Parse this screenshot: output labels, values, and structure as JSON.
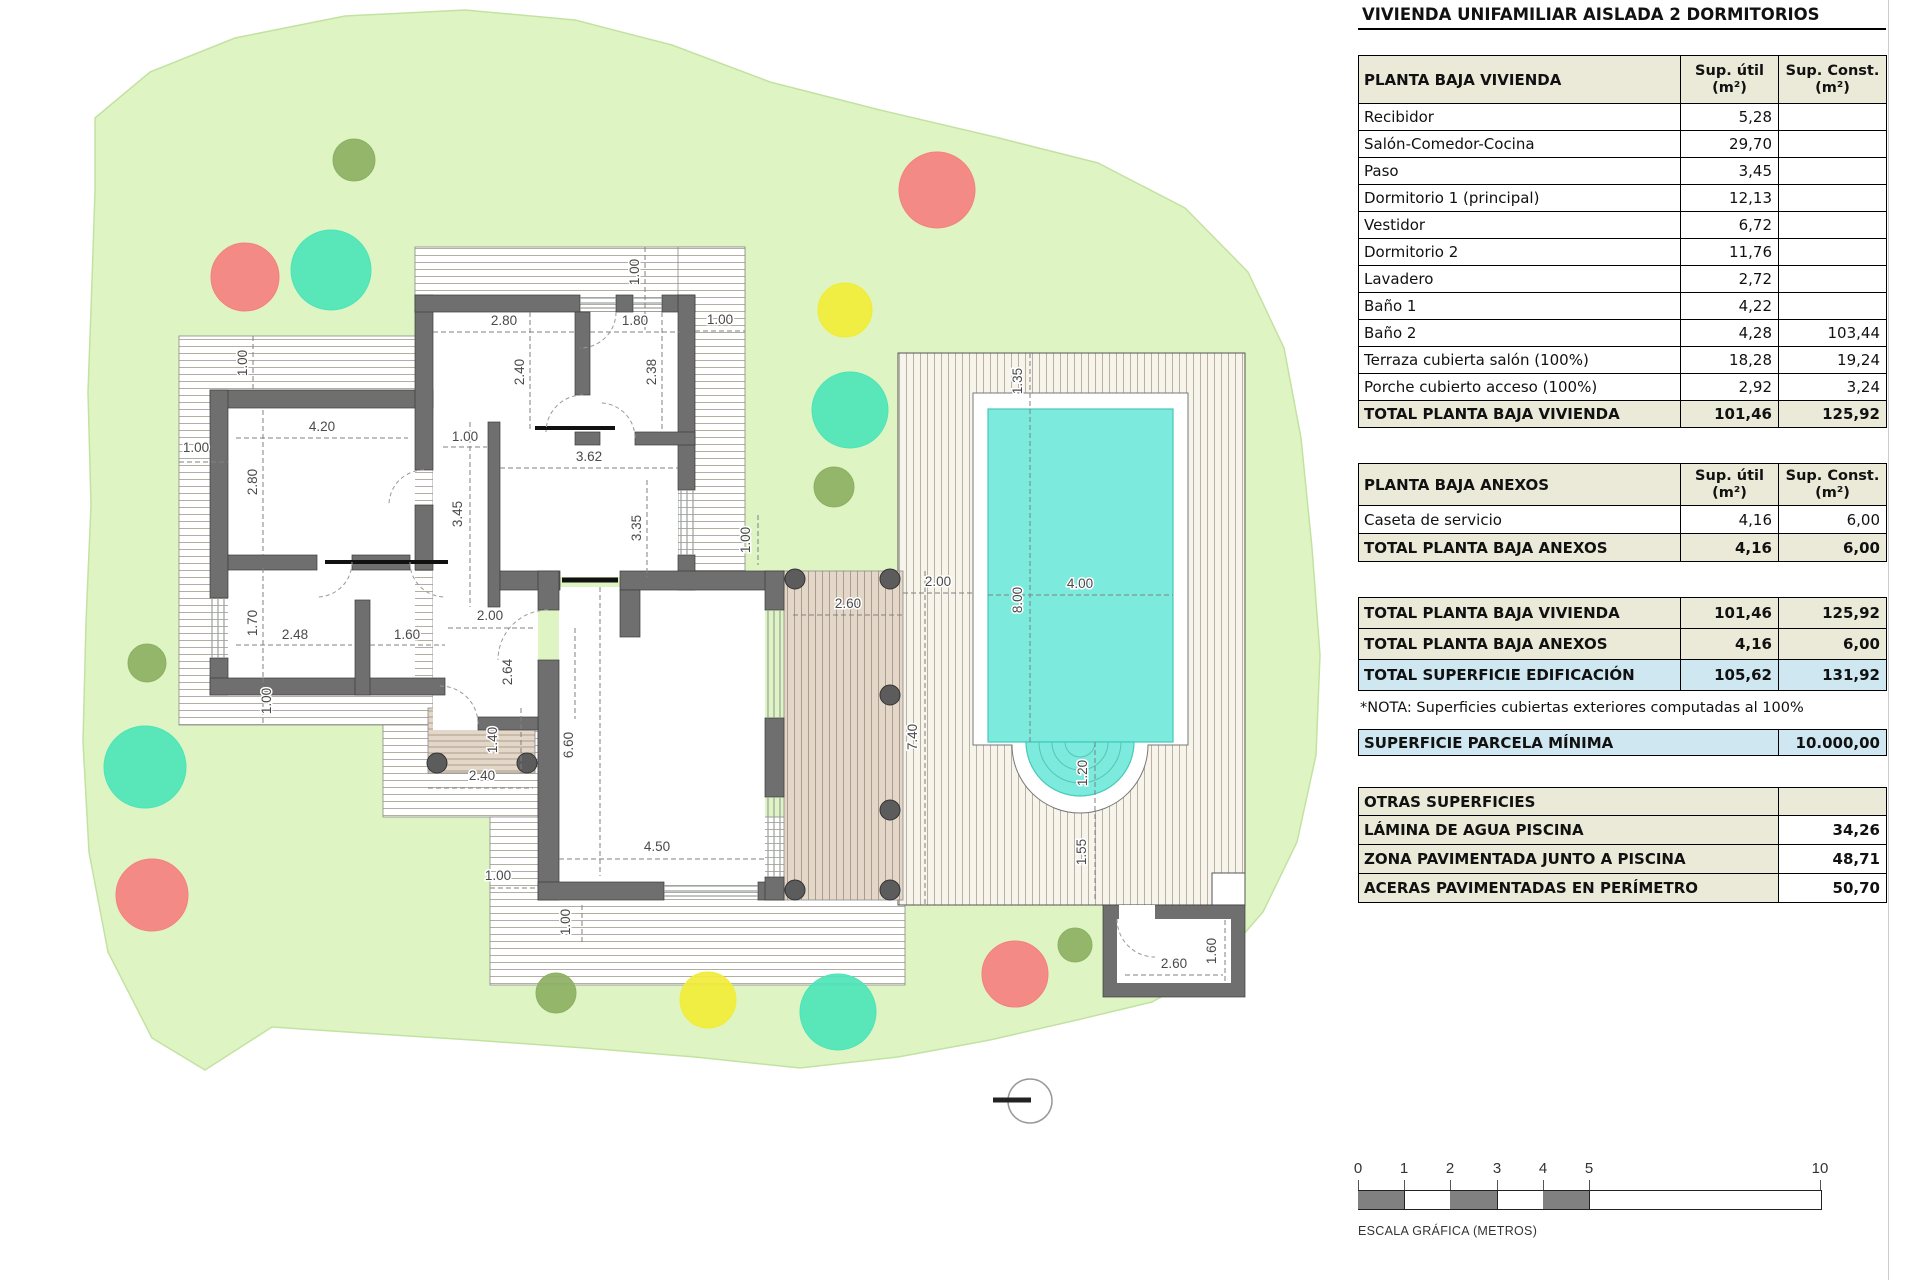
{
  "title": "VIVIENDA UNIFAMILIAR AISLADA 2 DORMITORIOS",
  "columns": {
    "util": "Sup. útil",
    "const": "Sup. Const.",
    "unit": "(m²)"
  },
  "tables": {
    "vivienda": {
      "header": "PLANTA BAJA VIVIENDA",
      "rows": [
        {
          "label": "Recibidor",
          "util": "5,28",
          "const": ""
        },
        {
          "label": "Salón-Comedor-Cocina",
          "util": "29,70",
          "const": ""
        },
        {
          "label": "Paso",
          "util": "3,45",
          "const": ""
        },
        {
          "label": "Dormitorio 1 (principal)",
          "util": "12,13",
          "const": ""
        },
        {
          "label": "Vestidor",
          "util": "6,72",
          "const": ""
        },
        {
          "label": "Dormitorio 2",
          "util": "11,76",
          "const": ""
        },
        {
          "label": "Lavadero",
          "util": "2,72",
          "const": ""
        },
        {
          "label": "Baño 1",
          "util": "4,22",
          "const": ""
        },
        {
          "label": "Baño 2",
          "util": "4,28",
          "const": "103,44"
        },
        {
          "label": "Terraza cubierta salón (100%)",
          "util": "18,28",
          "const": "19,24"
        },
        {
          "label": "Porche cubierto acceso (100%)",
          "util": "2,92",
          "const": "3,24"
        }
      ],
      "total": {
        "label": "TOTAL PLANTA BAJA VIVIENDA",
        "util": "101,46",
        "const": "125,92"
      }
    },
    "anexos": {
      "header": "PLANTA BAJA ANEXOS",
      "rows": [
        {
          "label": "Caseta de servicio",
          "util": "4,16",
          "const": "6,00"
        }
      ],
      "total": {
        "label": "TOTAL PLANTA BAJA ANEXOS",
        "util": "4,16",
        "const": "6,00"
      }
    },
    "resumen": {
      "rows": [
        {
          "label": "TOTAL PLANTA BAJA VIVIENDA",
          "util": "101,46",
          "const": "125,92",
          "style": "beige"
        },
        {
          "label": "TOTAL PLANTA BAJA ANEXOS",
          "util": "4,16",
          "const": "6,00",
          "style": "beige"
        },
        {
          "label": "TOTAL SUPERFICIE EDIFICACIÓN",
          "util": "105,62",
          "const": "131,92",
          "style": "blue"
        }
      ]
    },
    "nota": "*NOTA: Superficies cubiertas exteriores computadas al 100%",
    "parcela": {
      "label": "SUPERFICIE PARCELA MÍNIMA",
      "value": "10.000,00"
    },
    "otras": {
      "header": "OTRAS SUPERFICIES",
      "rows": [
        {
          "label": "LÁMINA DE AGUA PISCINA",
          "value": "34,26"
        },
        {
          "label": "ZONA PAVIMENTADA JUNTO A PISCINA",
          "value": "48,71"
        },
        {
          "label": "ACERAS PAVIMENTADAS EN PERÍMETRO",
          "value": "50,70"
        }
      ]
    }
  },
  "scalebar": {
    "ticks": [
      {
        "t": "0",
        "x": 0
      },
      {
        "t": "1",
        "x": 46
      },
      {
        "t": "2",
        "x": 92
      },
      {
        "t": "3",
        "x": 139
      },
      {
        "t": "4",
        "x": 185
      },
      {
        "t": "5",
        "x": 231
      },
      {
        "t": "10",
        "x": 462
      }
    ],
    "gray_segments": [
      [
        0,
        46
      ],
      [
        92,
        139
      ],
      [
        185,
        231
      ]
    ],
    "caption": "ESCALA GRÁFICA (METROS)"
  },
  "plan": {
    "colors": {
      "parcel": "#def5c3",
      "parcel_edge": "#c3e2a2",
      "wall": "#6f6f6f",
      "wall_edge": "#3c3c3c",
      "pool_water": "#7deade",
      "pool_edge": "#44c9bb",
      "tree_olive": "#8db064",
      "tree_red": "#f48080",
      "tree_teal": "#4de4b8",
      "tree_yellow": "#f1ec38"
    },
    "trees": [
      {
        "x": 354,
        "y": 160,
        "r": 21,
        "c": "#8db064"
      },
      {
        "x": 834,
        "y": 487,
        "r": 20,
        "c": "#8db064"
      },
      {
        "x": 147,
        "y": 663,
        "r": 19,
        "c": "#8db064"
      },
      {
        "x": 556,
        "y": 993,
        "r": 20,
        "c": "#8db064"
      },
      {
        "x": 1075,
        "y": 945,
        "r": 17,
        "c": "#8db064"
      },
      {
        "x": 245,
        "y": 277,
        "r": 34,
        "c": "#f48080"
      },
      {
        "x": 937,
        "y": 190,
        "r": 38,
        "c": "#f48080"
      },
      {
        "x": 152,
        "y": 895,
        "r": 36,
        "c": "#f48080"
      },
      {
        "x": 1015,
        "y": 974,
        "r": 33,
        "c": "#f48080"
      },
      {
        "x": 331,
        "y": 270,
        "r": 40,
        "c": "#4de4b8"
      },
      {
        "x": 850,
        "y": 410,
        "r": 38,
        "c": "#4de4b8"
      },
      {
        "x": 145,
        "y": 767,
        "r": 41,
        "c": "#4de4b8"
      },
      {
        "x": 838,
        "y": 1012,
        "r": 38,
        "c": "#4de4b8"
      },
      {
        "x": 845,
        "y": 310,
        "r": 27,
        "c": "#f1ec38"
      },
      {
        "x": 708,
        "y": 1000,
        "r": 28,
        "c": "#f1ec38"
      }
    ],
    "dimensions": [
      {
        "t": "4.20",
        "x": 322,
        "y": 431,
        "rot": false
      },
      {
        "t": "2.80",
        "x": 504,
        "y": 325,
        "rot": false
      },
      {
        "t": "1.80",
        "x": 635,
        "y": 325,
        "rot": false
      },
      {
        "t": "1.00",
        "x": 720,
        "y": 324,
        "rot": false
      },
      {
        "t": "1.00",
        "x": 196,
        "y": 452,
        "rot": false
      },
      {
        "t": "2.48",
        "x": 295,
        "y": 639,
        "rot": false
      },
      {
        "t": "1.60",
        "x": 407,
        "y": 639,
        "rot": false
      },
      {
        "t": "3.62",
        "x": 589,
        "y": 461,
        "rot": false
      },
      {
        "t": "2.00",
        "x": 490,
        "y": 620,
        "rot": false
      },
      {
        "t": "1.00",
        "x": 465,
        "y": 441,
        "rot": false
      },
      {
        "t": "4.50",
        "x": 657,
        "y": 851,
        "rot": false
      },
      {
        "t": "1.00",
        "x": 498,
        "y": 880,
        "rot": false
      },
      {
        "t": "2.60",
        "x": 848,
        "y": 608,
        "rot": false
      },
      {
        "t": "2.00",
        "x": 938,
        "y": 586,
        "rot": false
      },
      {
        "t": "4.00",
        "x": 1080,
        "y": 588,
        "rot": false
      },
      {
        "t": "2.60",
        "x": 1174,
        "y": 968,
        "rot": false
      },
      {
        "t": "2.40",
        "x": 482,
        "y": 780,
        "rot": false
      },
      {
        "t": "1.00",
        "x": 247,
        "y": 363,
        "rot": true
      },
      {
        "t": "2.80",
        "x": 257,
        "y": 482,
        "rot": true
      },
      {
        "t": "1.70",
        "x": 257,
        "y": 623,
        "rot": true
      },
      {
        "t": "2.40",
        "x": 524,
        "y": 372,
        "rot": true
      },
      {
        "t": "2.38",
        "x": 656,
        "y": 372,
        "rot": true
      },
      {
        "t": "1.00",
        "x": 639,
        "y": 272,
        "rot": true
      },
      {
        "t": "3.45",
        "x": 462,
        "y": 514,
        "rot": true
      },
      {
        "t": "3.35",
        "x": 641,
        "y": 528,
        "rot": true
      },
      {
        "t": "2.64",
        "x": 512,
        "y": 672,
        "rot": true
      },
      {
        "t": "6.60",
        "x": 573,
        "y": 745,
        "rot": true
      },
      {
        "t": "1.40",
        "x": 497,
        "y": 740,
        "rot": true
      },
      {
        "t": "1.00",
        "x": 570,
        "y": 922,
        "rot": true
      },
      {
        "t": "7.40",
        "x": 917,
        "y": 737,
        "rot": true
      },
      {
        "t": "8.00",
        "x": 1022,
        "y": 600,
        "rot": true
      },
      {
        "t": "1.35",
        "x": 1022,
        "y": 381,
        "rot": true
      },
      {
        "t": "1.20",
        "x": 1087,
        "y": 773,
        "rot": true
      },
      {
        "t": "1.55",
        "x": 1086,
        "y": 852,
        "rot": true
      },
      {
        "t": "1.60",
        "x": 1216,
        "y": 951,
        "rot": true
      },
      {
        "t": "1.00",
        "x": 271,
        "y": 701,
        "rot": true
      },
      {
        "t": "1.00",
        "x": 750,
        "y": 540,
        "rot": true
      }
    ]
  }
}
